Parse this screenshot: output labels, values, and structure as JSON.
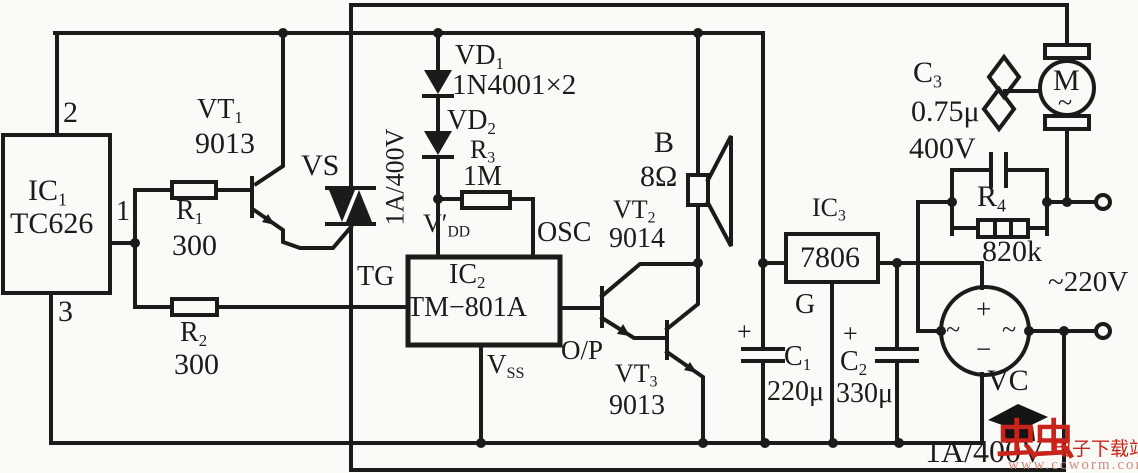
{
  "colors": {
    "ink": "#1b1b1b",
    "background": "#fbfaf7",
    "watermark_red": "#c9241c",
    "watermark_faint": "#d08b80"
  },
  "labels": {
    "pin2": "2",
    "pin1": "1",
    "pin3": "3",
    "ic1": {
      "t": "IC",
      "s": "1"
    },
    "ic1_part": "TC626",
    "r1": {
      "t": "R",
      "s": "1"
    },
    "r1_val": "300",
    "r2": {
      "t": "R",
      "s": "2"
    },
    "r2_val": "300",
    "vt1": {
      "t": "VT",
      "s": "1"
    },
    "vt1_part": "9013",
    "vs": "VS",
    "vs_rating": "1A/400V",
    "vd1": {
      "t": "VD",
      "s": "1"
    },
    "vd_part": "1N4001×2",
    "vd2": {
      "t": "VD",
      "s": "2"
    },
    "r3": {
      "t": "R",
      "s": "3"
    },
    "r3_val": "1M",
    "vdd": {
      "t": "V′",
      "s": "DD"
    },
    "osc": "OSC",
    "tg": "TG",
    "ic2": {
      "t": "IC",
      "s": "2"
    },
    "ic2_part": "TM−801A",
    "op": "O/P",
    "vss": {
      "t": "V",
      "s": "SS"
    },
    "speaker": "B",
    "speaker_val": "8Ω",
    "vt2": {
      "t": "VT",
      "s": "2"
    },
    "vt2_part": "9014",
    "vt3": {
      "t": "VT",
      "s": "3"
    },
    "vt3_part": "9013",
    "ic3": {
      "t": "IC",
      "s": "3"
    },
    "ic3_part": "7806",
    "g": "G",
    "c1": {
      "t": "C",
      "s": "1"
    },
    "c1_val": "220μ",
    "c2": {
      "t": "C",
      "s": "2"
    },
    "c2_val": "330μ",
    "plus": "+",
    "c3": {
      "t": "C",
      "s": "3"
    },
    "c3_val": "0.75μ",
    "c3_voltage": "400V",
    "r4": {
      "t": "R",
      "s": "4"
    },
    "r4_val": "820k",
    "mains": "~220V",
    "vc": "VC",
    "vc_rating": "1A/400V",
    "motor": "M",
    "motor_tilde": "~",
    "bridge_plus": "+",
    "bridge_minus": "−",
    "bridge_ac": "~"
  },
  "watermark": {
    "logo_text": "虫虫",
    "site_text": "电子下载站",
    "url_text": "www.ccworm.com"
  }
}
